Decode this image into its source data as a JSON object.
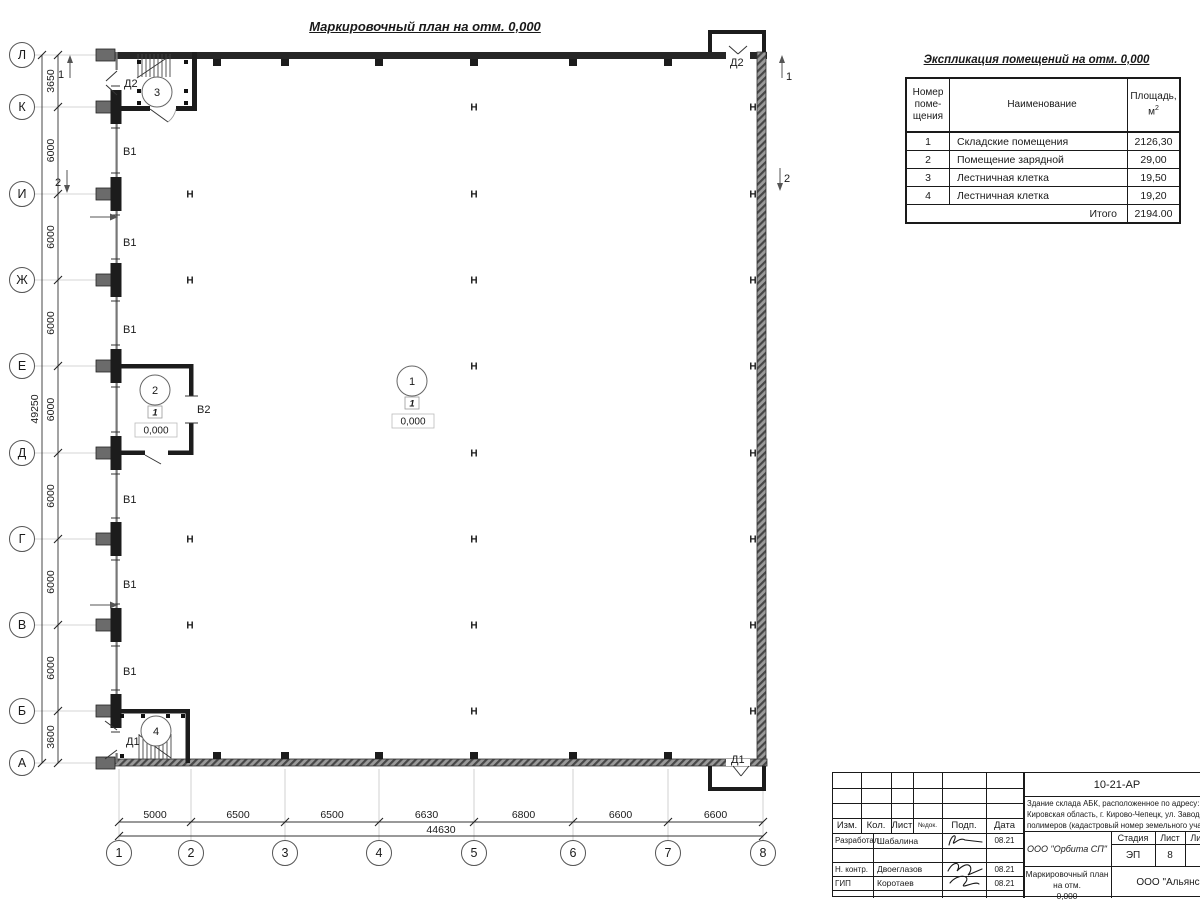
{
  "drawing_title": "Маркировочный план на отм. 0,000",
  "explication": {
    "title": "Экспликация помещений на отм. 0,000",
    "headers": {
      "num": [
        "Номер",
        "поме-",
        "щения"
      ],
      "name": "Наименование",
      "area_line1": "Площадь,",
      "area_base": "м",
      "area_sup": "2"
    },
    "rows": [
      {
        "num": "1",
        "name": "Складские помещения",
        "area": "2126,30"
      },
      {
        "num": "2",
        "name": "Помещение зарядной",
        "area": "29,00"
      },
      {
        "num": "3",
        "name": "Лестничная клетка",
        "area": "19,50"
      },
      {
        "num": "4",
        "name": "Лестничная клетка",
        "area": "19,20"
      }
    ],
    "total_label": "Итого",
    "total_value": "2194.00"
  },
  "plan": {
    "axes_left": [
      {
        "label": "Л",
        "y": 55
      },
      {
        "label": "К",
        "y": 107
      },
      {
        "label": "И",
        "y": 194
      },
      {
        "label": "Ж",
        "y": 280
      },
      {
        "label": "Е",
        "y": 366
      },
      {
        "label": "Д",
        "y": 453
      },
      {
        "label": "Г",
        "y": 539
      },
      {
        "label": "В",
        "y": 625
      },
      {
        "label": "Б",
        "y": 711
      },
      {
        "label": "А",
        "y": 763
      }
    ],
    "axes_bottom": [
      {
        "label": "1",
        "x": 119
      },
      {
        "label": "2",
        "x": 191
      },
      {
        "label": "3",
        "x": 285
      },
      {
        "label": "4",
        "x": 379
      },
      {
        "label": "5",
        "x": 474
      },
      {
        "label": "6",
        "x": 573
      },
      {
        "label": "7",
        "x": 668
      },
      {
        "label": "8",
        "x": 763
      }
    ],
    "dims_left": [
      "3650",
      "6000",
      "6000",
      "6000",
      "6000",
      "6000",
      "6000",
      "6000",
      "3600"
    ],
    "dims_left_total": "49250",
    "dims_bottom": [
      "5000",
      "6500",
      "6500",
      "6630",
      "6800",
      "6600",
      "6600"
    ],
    "dims_bottom_total": "44630",
    "gate_labels": [
      {
        "text": "В1",
        "x": 123,
        "y": 155
      },
      {
        "text": "В1",
        "x": 123,
        "y": 246
      },
      {
        "text": "В1",
        "x": 123,
        "y": 333
      },
      {
        "text": "В1",
        "x": 123,
        "y": 503
      },
      {
        "text": "В1",
        "x": 123,
        "y": 588
      },
      {
        "text": "В1",
        "x": 123,
        "y": 675
      },
      {
        "text": "В2",
        "x": 197,
        "y": 413
      }
    ],
    "door_labels": [
      {
        "text": "Д2",
        "x": 124,
        "y": 87
      },
      {
        "text": "Д2",
        "x": 730,
        "y": 66
      },
      {
        "text": "Д1",
        "x": 126,
        "y": 745
      },
      {
        "text": "Д1",
        "x": 731,
        "y": 763
      }
    ],
    "room_markers": [
      {
        "num": "1",
        "cx": 412,
        "cy": 381,
        "type": "1",
        "elev": "0,000"
      },
      {
        "num": "2",
        "cx": 155,
        "cy": 390,
        "type": "1",
        "elev": "0,000"
      },
      {
        "num": "3",
        "cx": 157,
        "cy": 92
      },
      {
        "num": "4",
        "cx": 156,
        "cy": 731
      }
    ],
    "section_marks": [
      {
        "num": "1",
        "x": 70,
        "y": 68,
        "dir": "up",
        "tx": 61,
        "ty": 78
      },
      {
        "num": "2",
        "x": 67,
        "y": 178,
        "dir": "down",
        "tx": 58,
        "ty": 186
      },
      {
        "num": "1",
        "x": 782,
        "y": 68,
        "dir": "up",
        "tx": 789,
        "ty": 80
      },
      {
        "num": "2",
        "x": 780,
        "y": 176,
        "dir": "down",
        "tx": 787,
        "ty": 182
      }
    ],
    "columns": {
      "x2": {
        "x": 190,
        "rows": [
          194,
          280,
          539,
          625
        ]
      },
      "x5": {
        "x": 474,
        "rows": [
          107,
          194,
          280,
          366,
          453,
          539,
          625,
          711
        ]
      },
      "right": {
        "x": 753,
        "rows": [
          107,
          194,
          280,
          366,
          453,
          539,
          625,
          711
        ]
      }
    },
    "entrance_arrows": [
      217,
      605
    ],
    "column_symbol": "Н"
  },
  "titleblock": {
    "doc_number": "10-21-АР",
    "description": [
      "Здание склада АБК, расположенное по адресу: Российская Феде",
      "Кировская область, г. Кирово-Чепецк, ул. Заводская, площадка з",
      "полимеров (кадастровый номер земельного участка 43:42:00000"
    ],
    "header_cols": [
      "Изм.",
      "Кол.",
      "Лист",
      "№док.",
      "Подп.",
      "Дата"
    ],
    "sign_rows": [
      {
        "role": "Разработал",
        "name": "Шабалина",
        "date": "08.21"
      },
      {
        "role": "Н. контр.",
        "name": "Двоеглазов",
        "date": "08.21"
      },
      {
        "role": "ГИП",
        "name": "Коротаев",
        "date": "08.21"
      }
    ],
    "company": "ООО \"Орбита СП\"",
    "stage_cols": [
      "Стадия",
      "Лист",
      "Листов"
    ],
    "stage_values": [
      "ЭП",
      "8",
      "1"
    ],
    "sheet_title": [
      "Маркировочный план на отм.",
      "0,000"
    ],
    "bottom_company": "ООО \"Альянс"
  }
}
